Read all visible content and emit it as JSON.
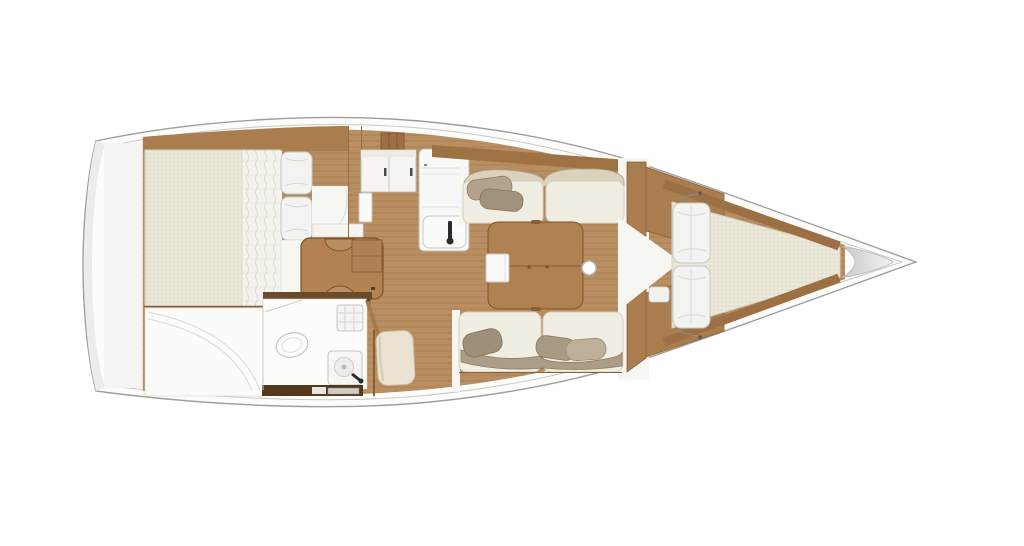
{
  "figure": {
    "kind": "sailboat-interior-floorplan",
    "orientation": "bow-right"
  },
  "palette": {
    "hull_fill": "#fcfcfb",
    "hull_stroke": "#9e9e9c",
    "inner_line": "#c9c9c6",
    "platform": "#f4f4f2",
    "wood": "#b98e60",
    "wood_band": "#aa7d4f",
    "wood_dark": "#9c7044",
    "wood_line": "#8a5f35",
    "plank_line": "#7a5230",
    "table": "#ae8151",
    "table_line": "#7d5327",
    "nav_table": "#b28252",
    "white_furniture": "#fafaf8",
    "white_floor": "#f6f6f3",
    "mattress": "#edeadd",
    "duvet": "#f3f2ec",
    "pillow_white": "#f3f3f1",
    "cushion": "#f0ede2",
    "cushion_line": "#d6cfbc",
    "bolster_top": "#dbd2be",
    "bolster_bottom": "#ab9d86",
    "pillow_taupe_a": "#b3a38c",
    "pillow_taupe_b": "#a2927b",
    "pillow_taupe_c": "#9d8f78",
    "pillow_taupe_d": "#beb098",
    "bath_wall_dark": "#6b4a2a",
    "bath_step_dark": "#53381d",
    "faucet_black": "#2b2b2b",
    "locker_gray_dark": "#cfcfcd",
    "locker_gray_light": "#f2f2f0",
    "seat_pillow_cream": "#eae3d3"
  },
  "components": [
    {
      "id": "hull",
      "label": "hull outline"
    },
    {
      "id": "stern-platform",
      "label": "stern platform"
    },
    {
      "id": "aft-cabin-berth",
      "label": "aft cabin double berth"
    },
    {
      "id": "aft-berth-duvet",
      "label": "quilted duvet"
    },
    {
      "id": "aft-berth-pillows",
      "label": "aft berth pillows"
    },
    {
      "id": "aft-cabin-doorway",
      "label": "aft cabin doorway"
    },
    {
      "id": "nav-table",
      "label": "chart / nav table"
    },
    {
      "id": "sail-locker",
      "label": "aft locker"
    },
    {
      "id": "head-compartment",
      "label": "head (bathroom)"
    },
    {
      "id": "toilet",
      "label": "toilet"
    },
    {
      "id": "shower-drain",
      "label": "shower drain grate"
    },
    {
      "id": "washbasin",
      "label": "washbasin with faucet"
    },
    {
      "id": "head-door",
      "label": "head door"
    },
    {
      "id": "galley-cabinets",
      "label": "galley cabinets"
    },
    {
      "id": "galley-counter",
      "label": "galley counter"
    },
    {
      "id": "galley-sink",
      "label": "galley sink with faucet"
    },
    {
      "id": "companionway-steps",
      "label": "companionway steps"
    },
    {
      "id": "salon-table",
      "label": "salon table"
    },
    {
      "id": "table-leaf",
      "label": "folding table leaf"
    },
    {
      "id": "mast-post",
      "label": "mast compression post"
    },
    {
      "id": "port-settee",
      "label": "port settee"
    },
    {
      "id": "starboard-settee",
      "label": "starboard settee"
    },
    {
      "id": "forward-bulkhead",
      "label": "forward bulkhead"
    },
    {
      "id": "vberth-mattress",
      "label": "V-berth mattress"
    },
    {
      "id": "vberth-pillows",
      "label": "V-berth pillows"
    },
    {
      "id": "anchor-locker",
      "label": "anchor locker"
    },
    {
      "id": "bow",
      "label": "bow"
    }
  ]
}
